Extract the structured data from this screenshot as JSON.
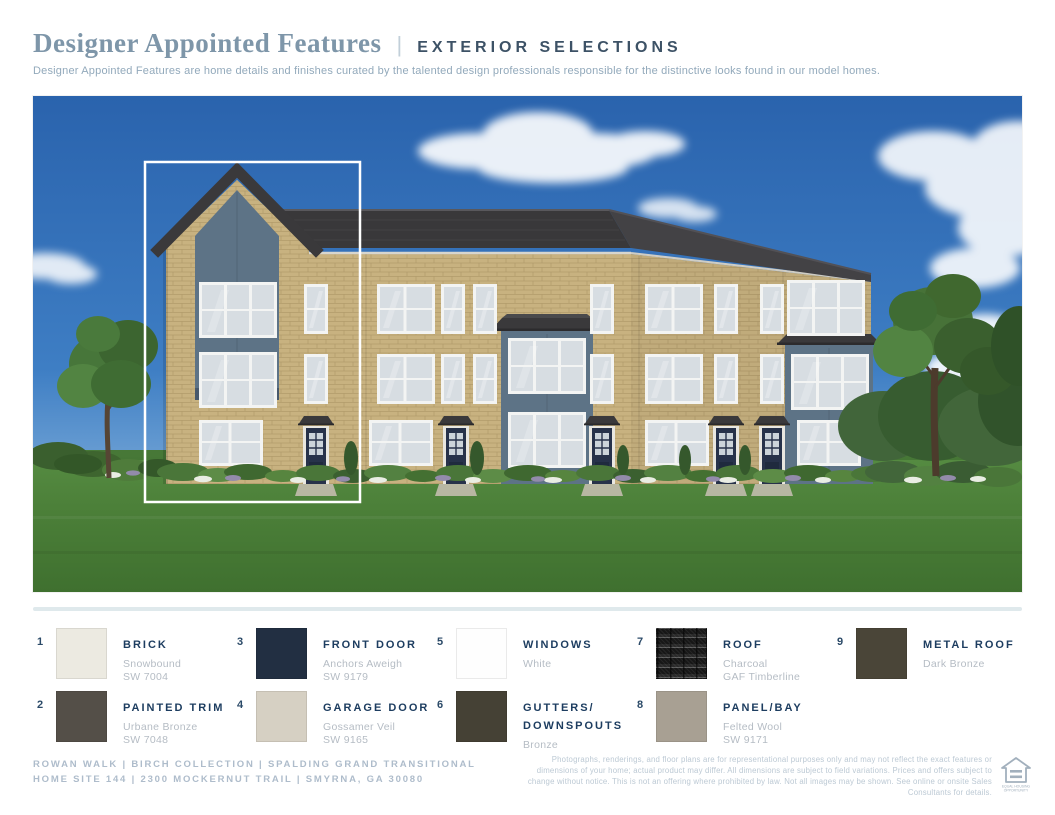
{
  "header": {
    "title": "Designer Appointed Features",
    "pipe": "|",
    "category": "EXTERIOR SELECTIONS",
    "description": "Designer Appointed Features are home details and finishes curated by the talented design professionals responsible for the distinctive looks found in our model homes."
  },
  "rendering": {
    "description": "Three-story brick townhome building rendering with blue-gray panel bays, dark front doors, charcoal shingle roof, lawn and trees; leftmost home site outlined in white",
    "colors": {
      "sky": "#2c67b2",
      "lawn": "#4c8039",
      "brick": "#c8b280",
      "panel": "#5d7386",
      "roof": "#39383a",
      "door": "#27324a",
      "highlight_outline": "#ffffff"
    }
  },
  "selections": [
    {
      "number": "1",
      "label": "BRICK",
      "detail": "Snowbound\nSW 7004",
      "swatch": "#ECEAE1"
    },
    {
      "number": "2",
      "label": "PAINTED TRIM",
      "detail": "Urbane Bronze\nSW 7048",
      "swatch": "#544F48"
    },
    {
      "number": "3",
      "label": "FRONT DOOR",
      "detail": "Anchors Aweigh\nSW 9179",
      "swatch": "#222F42"
    },
    {
      "number": "4",
      "label": "GARAGE DOOR",
      "detail": "Gossamer Veil\nSW 9165",
      "swatch": "#D6D0C3"
    },
    {
      "number": "5",
      "label": "WINDOWS",
      "detail": "White",
      "swatch": "#FEFEFE"
    },
    {
      "number": "6",
      "label": "GUTTERS/\nDOWNSPOUTS",
      "detail": "Bronze",
      "swatch": "#454135"
    },
    {
      "number": "7",
      "label": "ROOF",
      "detail": "Charcoal\nGAF Timberline",
      "swatch": "shingle"
    },
    {
      "number": "8",
      "label": "PANEL/BAY",
      "detail": "Felted Wool\nSW 9171",
      "swatch": "#A8A093"
    },
    {
      "number": "9",
      "label": "METAL ROOF",
      "detail": "Dark Bronze",
      "swatch": "#4A4538"
    }
  ],
  "footer": {
    "community": "ROWAN WALK   |   BIRCH COLLECTION   |   SPALDING GRAND TRANSITIONAL\nHOME SITE 144   |   2300 MOCKERNUT TRAIL   |   SMYRNA, GA 30080",
    "disclaimer": "Photographs, renderings, and floor plans are for representational purposes only and may not reflect the exact features or dimensions of your home; actual product may differ. All dimensions are subject to field variations. Prices and offers subject to change without notice. This is not an offering where prohibited by law. Not all images may be shown. See online or onsite Sales Consultants for details.",
    "equal_housing_line1": "EQUAL HOUSING",
    "equal_housing_line2": "OPPORTUNITY"
  }
}
